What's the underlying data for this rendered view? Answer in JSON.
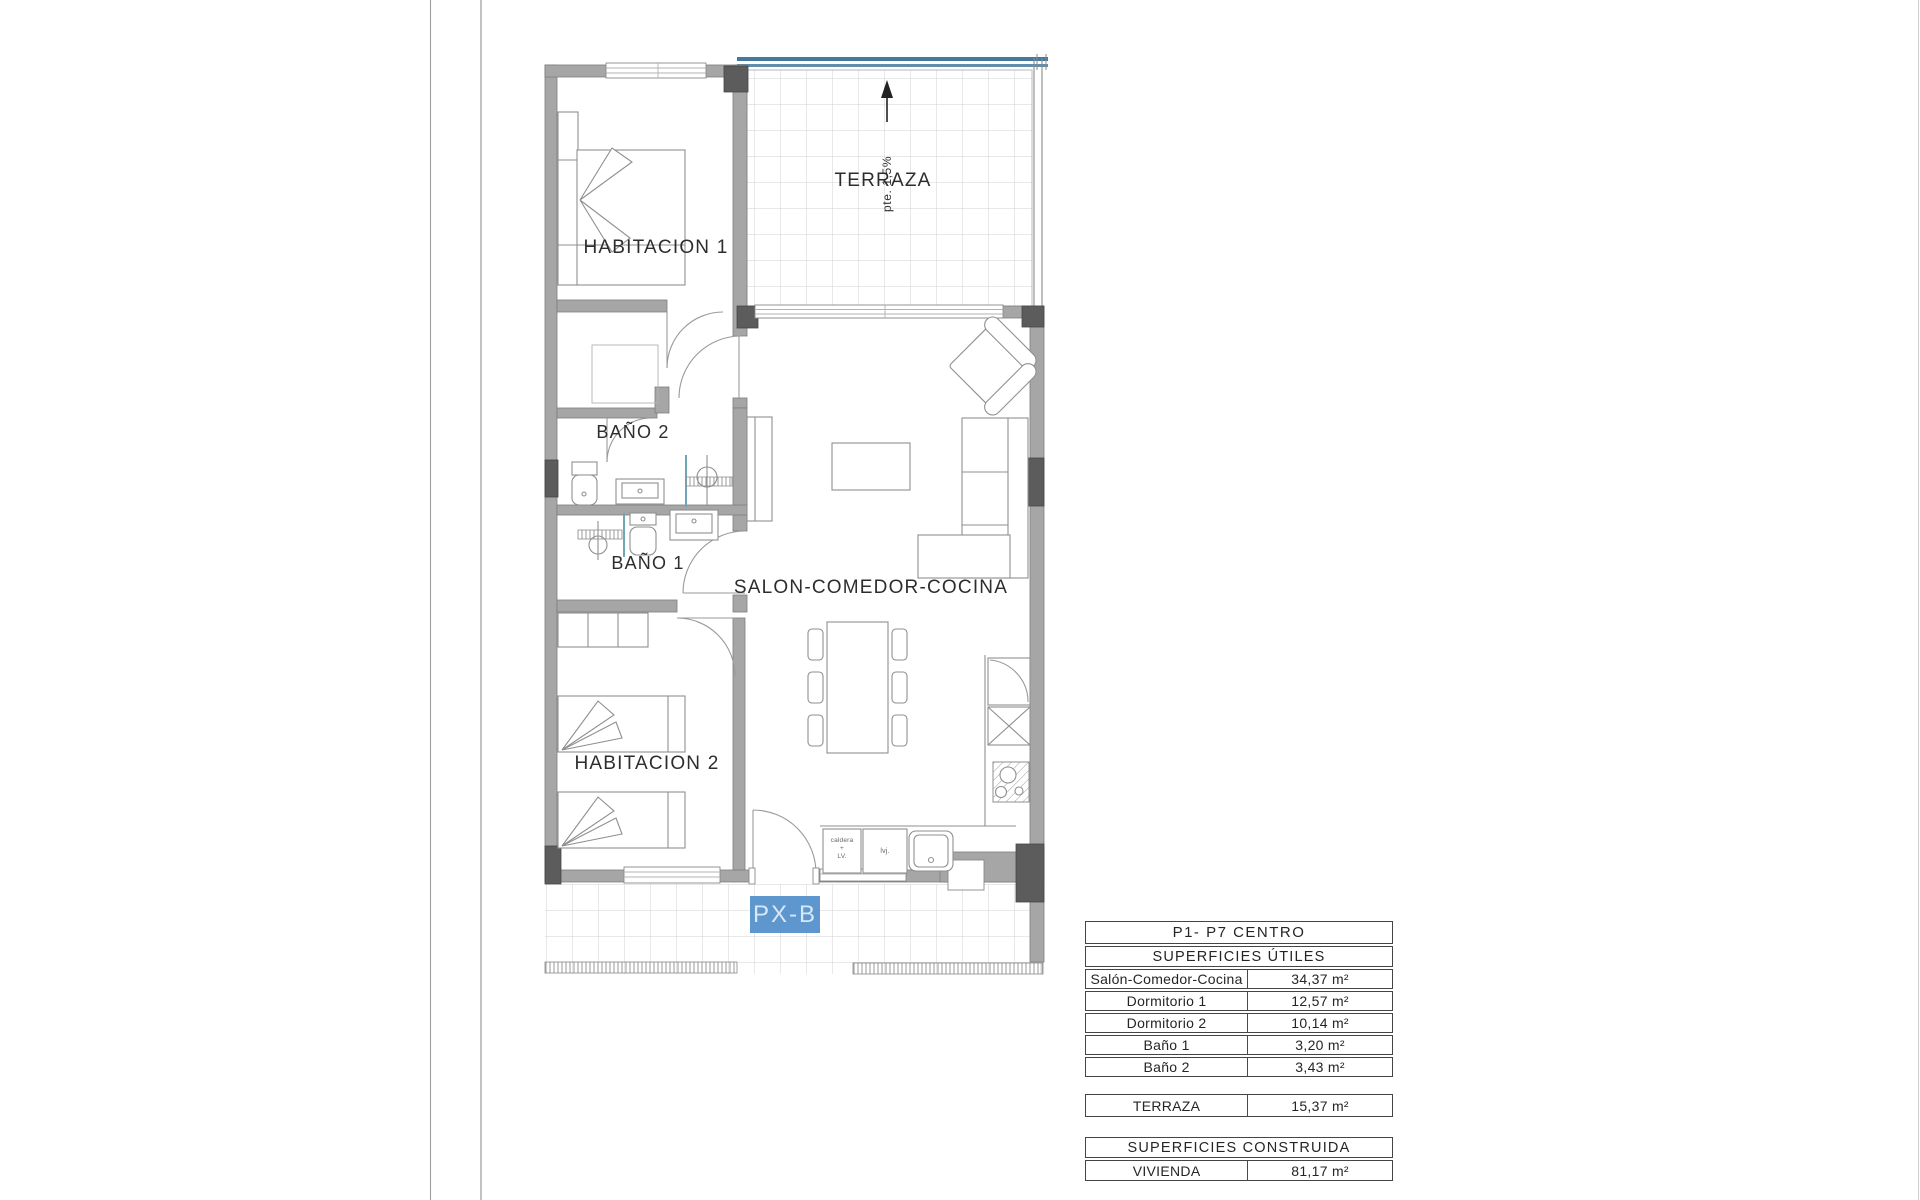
{
  "plan": {
    "labels": {
      "habitacion1": "HABITACION 1",
      "terraza": "TERRAZA",
      "bano2": "BAÑO 2",
      "bano1": "BAÑO 1",
      "salon": "SALON-COMEDOR-COCINA",
      "habitacion2": "HABITACION 2",
      "slope": "pte. 1,5%",
      "unit": "PX-B"
    },
    "kitchen": {
      "boiler_line1": "caldera",
      "boiler_line2": "+",
      "boiler_line3": "LV.",
      "dishwasher": "lvj."
    },
    "colors": {
      "wall": "#a6a6a6",
      "pillar": "#5c5c5c",
      "railing": "#44799e",
      "unit_bg": "#5e97ce",
      "tile_line": "#d2d2d2"
    }
  },
  "tables": {
    "utiles": {
      "title": "P1- P7 CENTRO",
      "subtitle": "SUPERFICIES ÚTILES",
      "rows": [
        {
          "label": "Salón-Comedor-Cocina",
          "value": "34,37 m²"
        },
        {
          "label": "Dormitorio 1",
          "value": "12,57 m²"
        },
        {
          "label": "Dormitorio 2",
          "value": "10,14 m²"
        },
        {
          "label": "Baño 1",
          "value": "3,20 m²"
        },
        {
          "label": "Baño 2",
          "value": "3,43 m²"
        }
      ]
    },
    "terraza_row": {
      "label": "TERRAZA",
      "value": "15,37 m²"
    },
    "construida": {
      "title": "SUPERFICIES CONSTRUIDA",
      "row": {
        "label": "VIVIENDA",
        "value": "81,17 m²"
      }
    }
  }
}
